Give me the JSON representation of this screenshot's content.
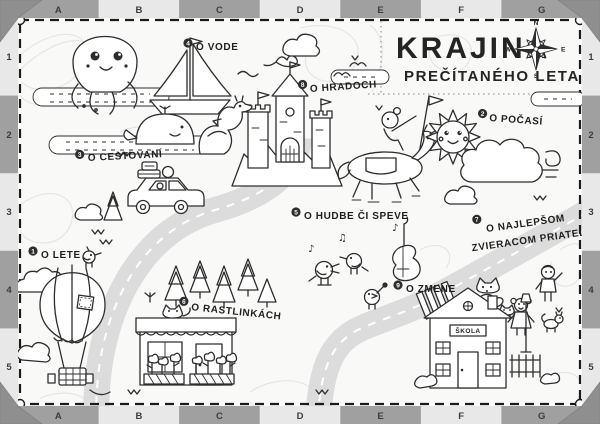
{
  "title": {
    "line1": "KRAJINA",
    "line2": "PREČÍTANÉHO LETA"
  },
  "compass": {
    "n": "N",
    "e": "E",
    "s": "S",
    "w": "W"
  },
  "frame": {
    "columns": [
      "A",
      "B",
      "C",
      "D",
      "E",
      "F",
      "G"
    ],
    "rows": [
      "1",
      "2",
      "3",
      "4",
      "5"
    ],
    "dark_cell_color": "#a0a0a0",
    "light_cell_color": "#e8e8e8",
    "corner_color": "#8f8f8f"
  },
  "stations": [
    {
      "num": "4",
      "label": "O VODE"
    },
    {
      "num": "8",
      "label": "O HRADOCH"
    },
    {
      "num": "3",
      "label": "O CESTOVANÍ"
    },
    {
      "num": "2",
      "label": "O POČASÍ"
    },
    {
      "num": "5",
      "label": "O HUDBE ČI SPEVE"
    },
    {
      "num": "7",
      "label": "O NAJLEPŠOM",
      "label2": "ZVIERACOM PRIATEĽOVI"
    },
    {
      "num": "1",
      "label": "O LETE"
    },
    {
      "num": "6",
      "label": "O RASTLINKÁCH"
    },
    {
      "num": "9",
      "label": "O ZMENE"
    }
  ],
  "school_sign": "ŠKOLA",
  "music_notes": [
    "♪",
    "♫",
    "♪"
  ],
  "colors": {
    "ink": "#2d2d2d",
    "road": "#dcdcdc",
    "paper": "#f9f9f7",
    "contour": "#e4e4e0"
  }
}
